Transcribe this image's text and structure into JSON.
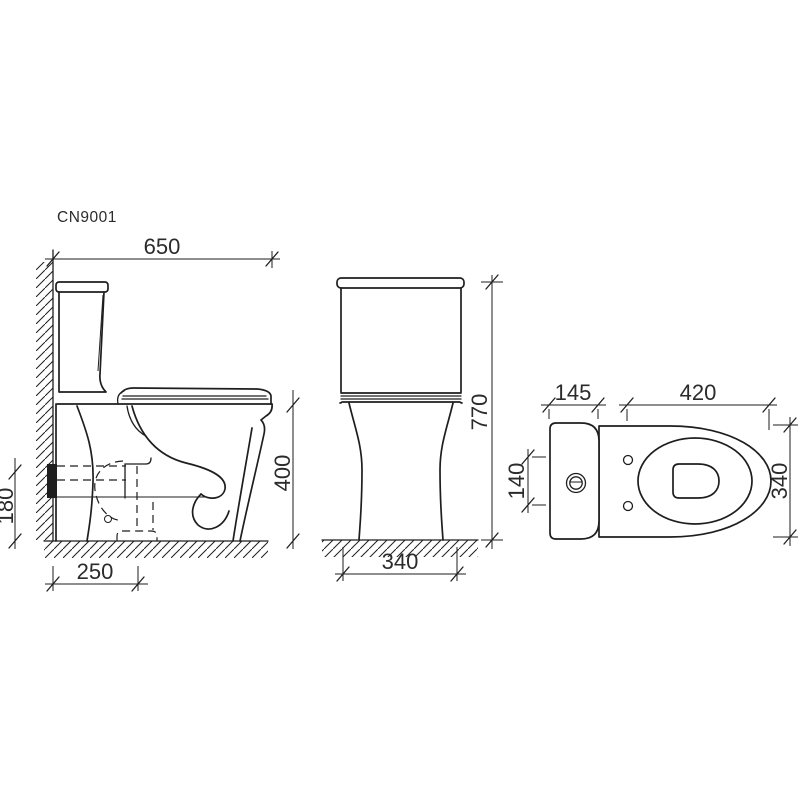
{
  "drawing": {
    "model_label": "CN9001",
    "side_view": {
      "overall_depth": "650",
      "seat_height": "400",
      "outlet_height": "180",
      "outlet_offset": "250"
    },
    "front_view": {
      "overall_height": "770",
      "overall_width": "340"
    },
    "top_view": {
      "tank_depth": "145",
      "bowl_length": "420",
      "button_span": "140",
      "bowl_width": "340"
    },
    "colors": {
      "line": "#1e1e1e",
      "text": "#2b2b2b",
      "background": "#ffffff"
    }
  }
}
